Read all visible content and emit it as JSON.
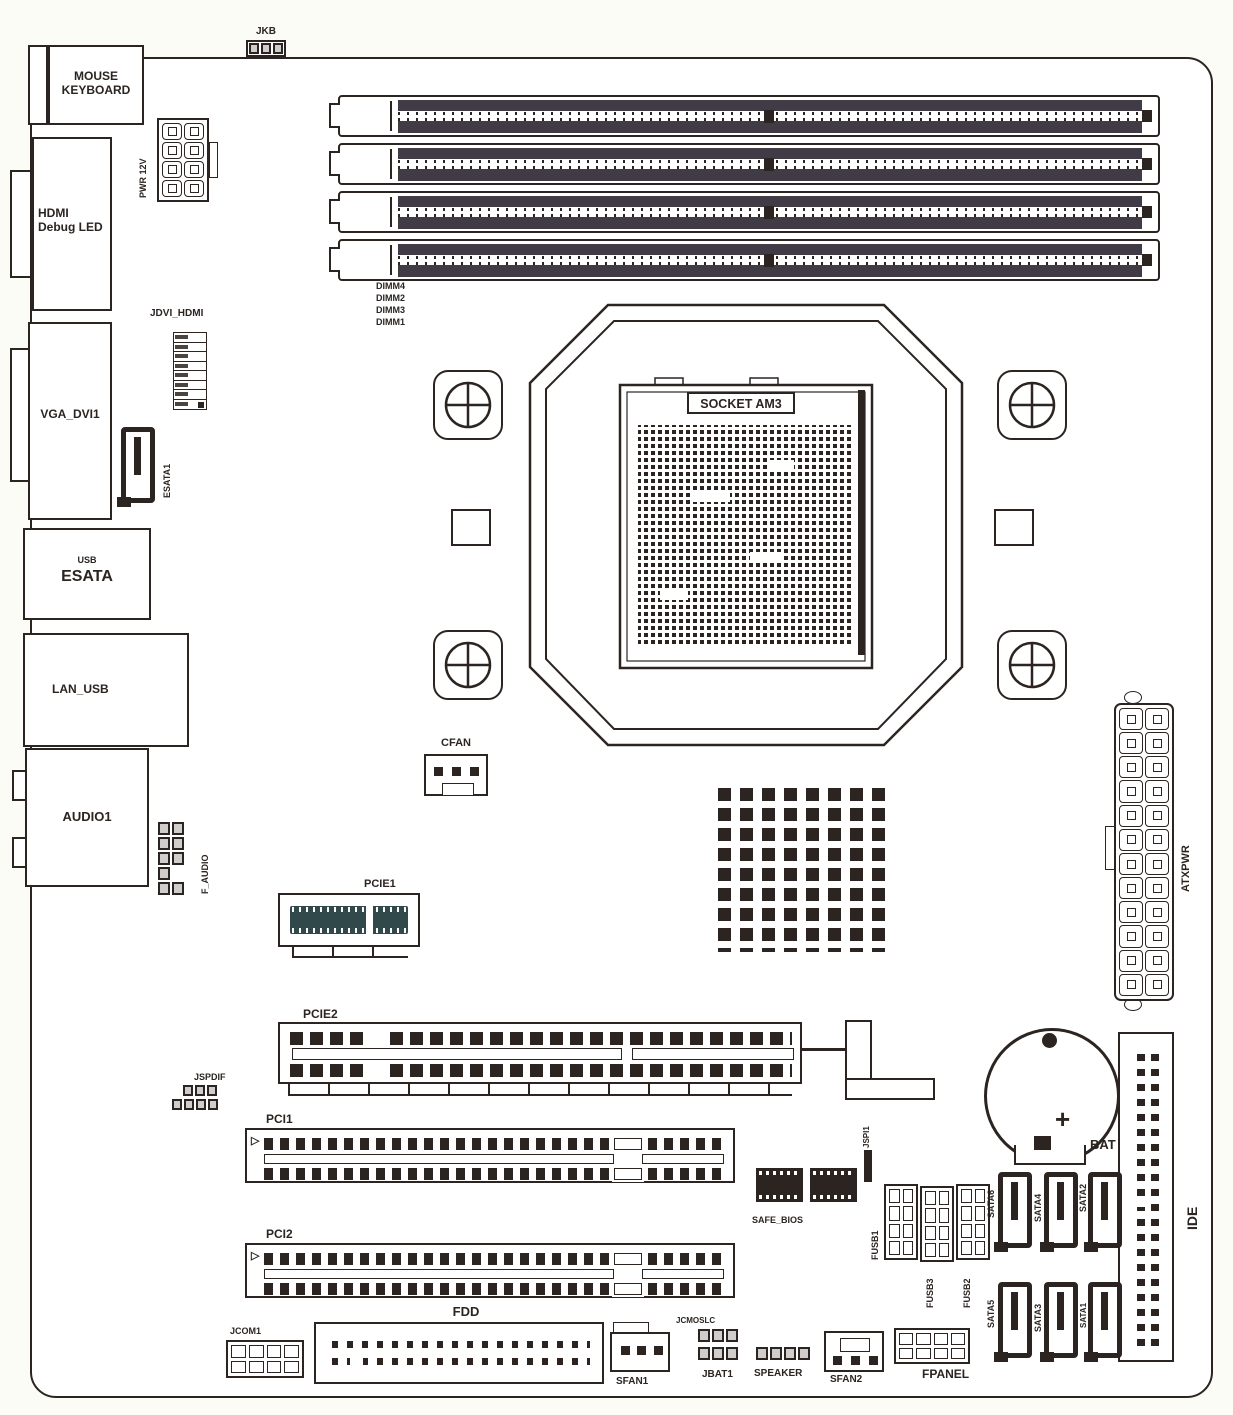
{
  "colors": {
    "ink": "#2b2420",
    "dimm_slot": "#413b46",
    "pcie_slot": "#31494a",
    "pin_gray": "#cfcecc",
    "background": "#fcfcf7"
  },
  "io": {
    "mouse1": "MOUSE",
    "mouse2": "KEYBOARD",
    "hdmi1": "HDMI",
    "hdmi2": "Debug LED",
    "vga": "VGA_DVI1",
    "usb": "USB",
    "esata": "ESATA",
    "lan": "LAN_USB",
    "audio": "AUDIO1"
  },
  "conn": {
    "jkb": "JKB",
    "pwr12v": "PWR 12V",
    "jdvi": "JDVI_HDMI",
    "esata1": "ESATA1",
    "faudio": "F_AUDIO",
    "cfan": "CFAN",
    "atxpwr": "ATXPWR",
    "jspdif": "JSPDIF",
    "safebios": "SAFE_BIOS",
    "jspi": "JSPI1",
    "fusb1": "FUSB1",
    "fusb2": "FUSB2",
    "fusb3": "FUSB3",
    "bat": "BAT",
    "batplus": "+",
    "ide": "IDE",
    "jcom1": "JCOM1",
    "fdd": "FDD",
    "sfan1": "SFAN1",
    "jcmos": "JCMOSLC",
    "jbat1": "JBAT1",
    "speaker": "SPEAKER",
    "sfan2": "SFAN2",
    "fpanel": "FPANEL"
  },
  "cpu": {
    "socket": "SOCKET AM3"
  },
  "slots": {
    "pcie1": "PCIE1",
    "pcie2": "PCIE2",
    "pci1": "PCI1",
    "pci2": "PCI2",
    "marker": "▷"
  },
  "dimm": {
    "labels": [
      "DIMM4",
      "DIMM2",
      "DIMM3",
      "DIMM1"
    ]
  },
  "sata": {
    "row1": [
      "SATA6",
      "SATA4",
      "SATA2"
    ],
    "row2": [
      "SATA5",
      "SATA3",
      "SATA1"
    ]
  }
}
